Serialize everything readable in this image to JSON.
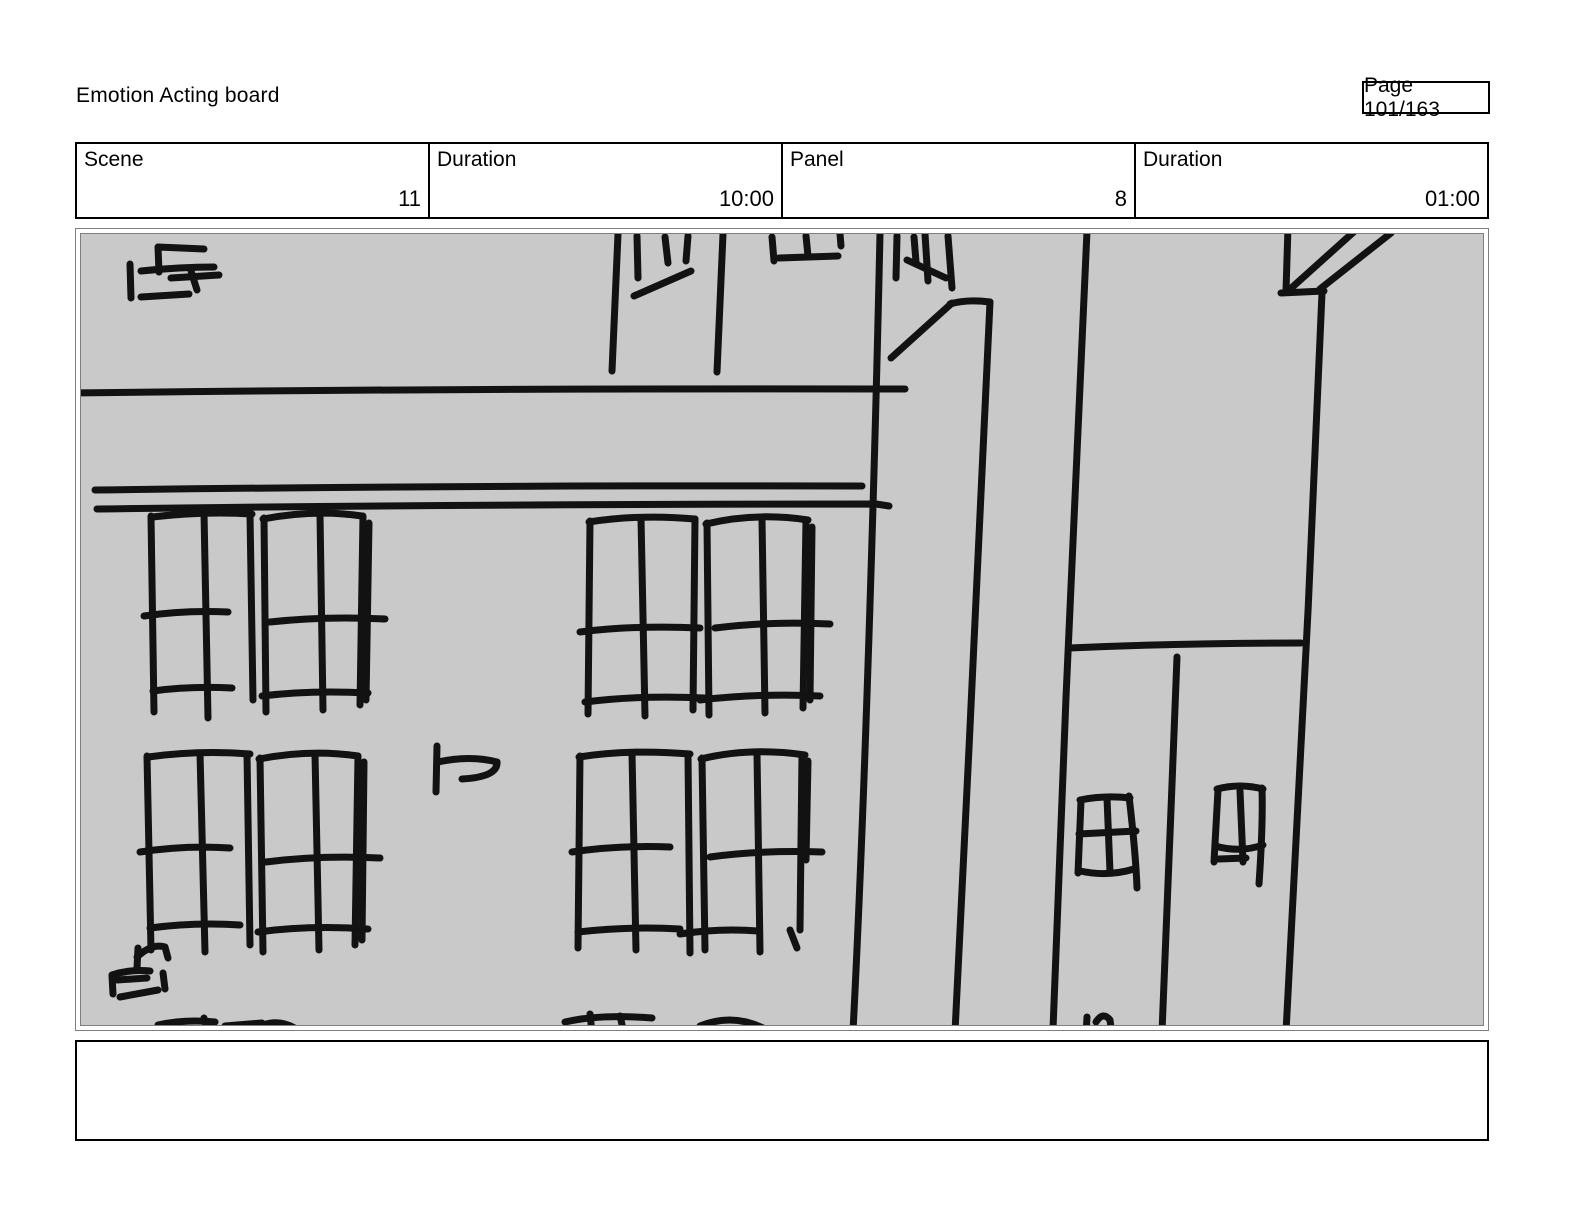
{
  "page": {
    "title": "Emotion Acting board",
    "page_indicator": "Page 101/163"
  },
  "header": {
    "cells": [
      {
        "label": "Scene",
        "value": "11"
      },
      {
        "label": "Duration",
        "value": "10:00"
      },
      {
        "label": "Panel",
        "value": "8"
      },
      {
        "label": "Duration",
        "value": "01:00"
      }
    ]
  },
  "notes": {
    "text": ""
  },
  "panel": {
    "background": "#c9c9c9",
    "border_color": "#7f7f7f",
    "description": "hand-drawn sketch: street corner with building facades, grid windows and sign scribbles"
  },
  "sketch": {
    "stroke_color": "#121212",
    "stroke_width": 7,
    "paths": [
      "M75,393 Q470,388 905,389",
      "M95,490 Q480,485 862,486",
      "M97,509 Q480,504 876,504 L889,506",
      "M130,264 L131,298",
      "M159,272 L158,247 L204,249",
      "M141,271 Q180,267 214,267",
      "M171,278 L219,275",
      "M191,271 L197,290",
      "M141,297 L189,294",
      "M618,234 L612,371",
      "M637,236 L638,278",
      "M665,237 L668,263",
      "M688,236 L686,261",
      "M634,296 L691,271",
      "M723,234 L717,372",
      "M772,237 L774,261",
      "M779,258 L838,256",
      "M806,236 L808,256",
      "M840,234 L841,246",
      "M880,233 C876,420 866,780 853,1031",
      "M897,236 L896,278",
      "M914,237 L916,262",
      "M925,234 L928,281",
      "M948,236 L952,288",
      "M907,260 L946,278",
      "M891,358 L952,303",
      "M950,304 Q967,299 990,302",
      "M990,302 C982,470 967,800 955,1032",
      "M1087,231 C1077,430 1062,780 1053,1029",
      "M1069,648 Q1180,643 1301,643",
      "M1177,657 C1172,780 1167,920 1162,1032",
      "M1288,227 L1286,291",
      "M1281,293 L1324,291",
      "M1322,293 C1313,520 1297,850 1286,1032",
      "M1288,291 L1357,229",
      "M1320,289 L1391,233",
      "M1081,801 L1078,873",
      "M1080,800 Q1105,795 1130,798",
      "M1129,796 C1133,830 1136,860 1137,888",
      "M1107,798 L1110,872",
      "M1079,834 L1136,831",
      "M1080,871 Q1108,877 1134,869",
      "M1218,790 L1214,862",
      "M1217,789 Q1240,783 1263,789",
      "M1262,788 C1263,820 1261,855 1259,884",
      "M1240,791 L1243,862",
      "M1215,846 Q1240,853 1263,845",
      "M1219,859 L1246,858",
      "M151,516 L154,712",
      "M152,517 Q205,511 252,514",
      "M204,513 L208,718",
      "M250,514 L253,700",
      "M144,616 Q185,610 228,612",
      "M153,691 Q190,686 232,688",
      "M264,518 L266,712",
      "M263,519 Q315,509 362,516",
      "M320,514 L323,710",
      "M363,516 L360,705",
      "M369,523 L366,700",
      "M270,622 Q325,616 385,619",
      "M262,696 Q310,690 368,693",
      "M590,521 L588,714",
      "M589,522 Q640,514 695,519",
      "M641,518 L645,716",
      "M695,519 L693,710",
      "M580,632 Q635,625 700,628",
      "M585,702 Q640,695 705,698",
      "M707,523 L709,715",
      "M706,524 Q755,512 808,520",
      "M762,519 L765,713",
      "M806,520 L803,708",
      "M812,527 L810,700",
      "M715,628 Q770,621 830,624",
      "M700,700 Q760,693 820,696",
      "M147,756 L151,950",
      "M148,757 Q200,750 250,754",
      "M200,753 L205,952",
      "M247,754 L250,945",
      "M140,852 Q185,845 230,848",
      "M150,928 Q195,922 240,925",
      "M260,758 L263,952",
      "M259,759 Q310,749 358,756",
      "M315,754 L319,950",
      "M358,756 L355,945",
      "M364,762 L362,940",
      "M266,862 Q320,855 380,858",
      "M258,932 Q310,925 368,929",
      "M580,756 L578,948",
      "M579,757 Q630,749 690,754",
      "M632,753 L636,950",
      "M688,754 L690,953",
      "M572,852 Q620,845 670,847",
      "M578,932 Q630,926 680,929",
      "M702,758 L705,950",
      "M701,759 Q750,747 805,755",
      "M757,754 L760,952",
      "M802,755 L800,930",
      "M808,761 L806,860",
      "M790,930 L797,948",
      "M710,857 Q760,850 822,852",
      "M680,934 Q720,928 758,931",
      "M437,746 L436,792",
      "M438,762 Q470,755 497,762",
      "M497,762 Q498,777 462,779",
      "M138,948 L137,968",
      "M137,957 Q152,943 165,947 L168,958",
      "M112,975 Q130,969 150,971",
      "M112,976 L113,994",
      "M117,980 L147,978",
      "M163,973 L165,989",
      "M120,997 L158,990",
      "M158,1025 Q185,1019 215,1022",
      "M204,1018 L208,1033",
      "M225,1026 L262,1023",
      "M263,1025 Q283,1018 302,1033",
      "M565,1022 Q600,1014 652,1018",
      "M590,1014 L592,1033",
      "M620,1016 L624,1033",
      "M700,1026 Q732,1013 763,1028",
      "M1087,1017 L1086,1035",
      "M1096,1022 Q1103,1011 1110,1020 L1112,1035"
    ]
  }
}
